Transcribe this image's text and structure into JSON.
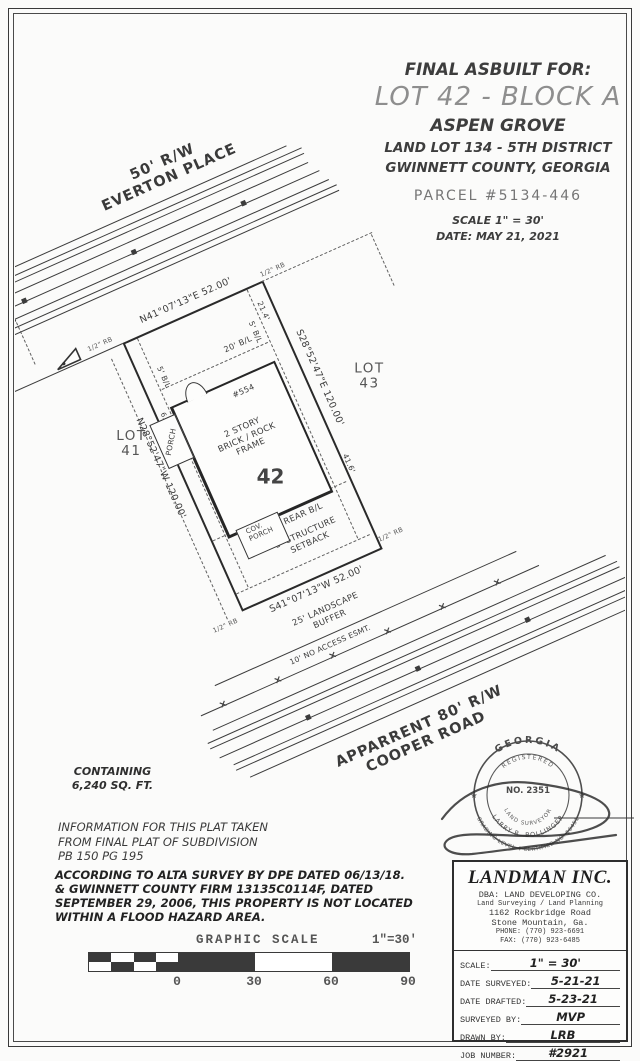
{
  "title_block": {
    "line1": "FINAL ASBUILT FOR:",
    "line2": "LOT 42 - BLOCK A",
    "line3": "ASPEN GROVE",
    "line4": "LAND LOT 134 - 5TH DISTRICT",
    "line5": "GWINNETT COUNTY, GEORGIA",
    "parcel": "PARCEL #5134-446",
    "scale": "SCALE 1\" = 30'",
    "date": "DATE: MAY 21, 2021"
  },
  "plat": {
    "everton": {
      "rw": "50' R/W",
      "name": "EVERTON PLACE"
    },
    "cooper": {
      "rw": "APPARRENT 80' R/W",
      "name": "COOPER ROAD"
    },
    "lot_number": "42",
    "lot_left": {
      "line1": "LOT",
      "line2": "41"
    },
    "lot_right": {
      "line1": "LOT",
      "line2": "43"
    },
    "bearing_front": "N41°07'13\"E 52.00'",
    "bearing_left": "N28°52'47\"W 120.00'",
    "bearing_right": "S28°52'47\"E 120.00'",
    "bearing_rear": "S41°07'13\"W 52.00'",
    "bl_front": "20' B/L",
    "bl_side_left": "5' B/L",
    "bl_side_right": "5' B/L",
    "bl_rear": "25' REAR B/L",
    "structure_setback_1": "5' STRUCTURE",
    "structure_setback_2": "SETBACK",
    "landscape_1": "25' LANDSCAPE",
    "landscape_2": "BUFFER",
    "no_access": "10' NO ACCESS ESMT.",
    "house": {
      "number": "#554",
      "desc1": "2 STORY",
      "desc2": "BRICK / ROCK",
      "desc3": "FRAME",
      "porch": "PORCH",
      "cov_porch_1": "COV.",
      "cov_porch_2": "PORCH"
    },
    "dim_front_right": "21.4'",
    "dim_right": "41.6'",
    "dim_porch": "6.3'",
    "corner_marker": "1/2\" RB"
  },
  "notes": {
    "containing_1": "CONTAINING",
    "containing_2": "6,240 SQ. FT.",
    "plat_info_1": "INFORMATION FOR THIS PLAT TAKEN",
    "plat_info_2": "FROM FINAL PLAT OF SUBDIVISION",
    "plat_info_3": "PB 150 PG 195",
    "flood_1": "ACCORDING TO ALTA SURVEY BY DPE DATED 06/13/18.",
    "flood_2": "& GWINNETT COUNTY FIRM 13135C0114F, DATED",
    "flood_3": "SEPTEMBER 29, 2006, THIS PROPERTY IS NOT LOCATED",
    "flood_4": "WITHIN A FLOOD HAZARD AREA."
  },
  "graphic_scale": {
    "title": "GRAPHIC SCALE",
    "ratio": "1\"=30'",
    "ticks": [
      "0",
      "30",
      "60",
      "90"
    ]
  },
  "stamp": {
    "state": "GEORGIA",
    "registered": "REGISTERED",
    "number": "NO. 2351",
    "surveyor": "LAND SURVEYOR",
    "name": "LARRY R. BOLLINGER",
    "cert": "GRADING LEVEL 4 CERTIFIED NO. 16451",
    "star": "★"
  },
  "firm_block": {
    "name": "LANDMAN INC.",
    "dba": "DBA: LAND DEVELOPING CO.",
    "services": "Land Surveying / Land Planning",
    "address1": "1162 Rockbridge Road",
    "address2": "Stone Mountain, Ga.",
    "phone": "PHONE: (770) 923-6691",
    "fax": "FAX: (770) 923-6485",
    "rows": [
      {
        "label": "SCALE:",
        "value": "1\" = 30'"
      },
      {
        "label": "DATE SURVEYED:",
        "value": "5-21-21"
      },
      {
        "label": "DATE DRAFTED:",
        "value": "5-23-21"
      },
      {
        "label": "SURVEYED BY:",
        "value": "MVP"
      },
      {
        "label": "DRAWN BY:",
        "value": "LRB"
      },
      {
        "label": "JOB NUMBER:",
        "value": "#2921"
      }
    ]
  }
}
